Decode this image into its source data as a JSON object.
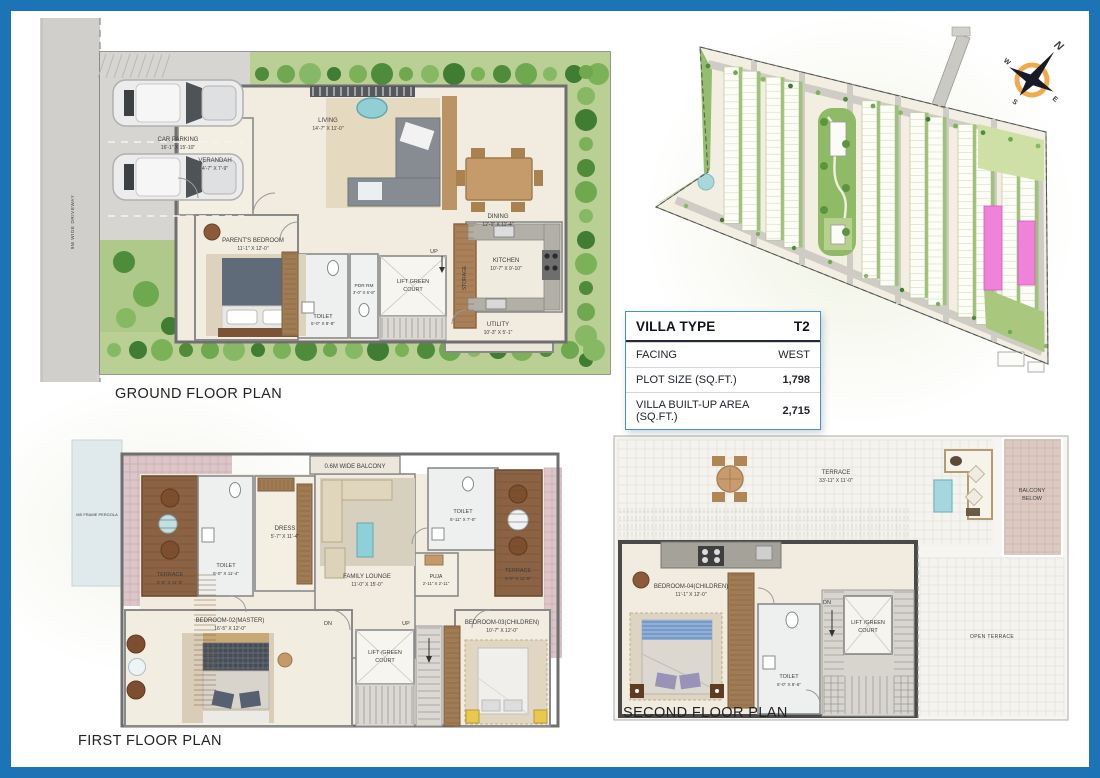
{
  "page": {
    "border_color": "#1c73b6",
    "background": "#ffffff"
  },
  "titles": {
    "ground": "GROUND FLOOR PLAN",
    "first": "FIRST FLOOR PLAN",
    "second": "SECOND FLOOR PLAN"
  },
  "villa_table": {
    "header_label": "VILLA TYPE",
    "header_value": "T2",
    "rows": [
      {
        "label": "FACING",
        "value": "WEST"
      },
      {
        "label": "PLOT SIZE (SQ.FT.)",
        "value": "1,798"
      },
      {
        "label": "VILLA BUILT-UP AREA (SQ.FT.)",
        "value": "2,715"
      }
    ]
  },
  "site_plan": {
    "compass": {
      "north": "N",
      "east": "E",
      "south": "S",
      "west": "W"
    },
    "highlight_color": "#ef82d9"
  },
  "ground_floor": {
    "driveway": "9M WIDE DRIVEWAY",
    "up": "UP",
    "car_parking": {
      "name": "CAR PARKING",
      "dims": "16'-1\" X 15'-10\""
    },
    "verandah": {
      "name": "VERANDAH",
      "dims": "4'-7\" X 7'-9\""
    },
    "living": {
      "name": "LIVING",
      "dims": "14'-7\" X 11'-0\""
    },
    "dining": {
      "name": "DINING",
      "dims": "12'-9\" X 11'-4\""
    },
    "kitchen": {
      "name": "KITCHEN",
      "dims": "10'-7\" X 9'-10\""
    },
    "parents_bedroom": {
      "name": "PARENT'S BEDROOM",
      "dims": "11'-1\" X 12'-0\""
    },
    "toilet": {
      "name": "TOILET",
      "dims": "5'-0\" X 8'-8\""
    },
    "pdr": {
      "name": "PDR RM",
      "dims": "3'-0\" X 6'-8\""
    },
    "lift": {
      "line1": "LIFT GREEN",
      "line2": "COURT"
    },
    "storage": "STORAGE",
    "utility": {
      "name": "UTILITY",
      "dims": "10'-3\" X 5'-1\""
    }
  },
  "first_floor": {
    "pergola": "MS FRAME PERGOLA",
    "balcony": "0.6M WIDE BALCONY",
    "terrace_left": {
      "name": "TERRACE",
      "dims": "5'-6\" X 11'-8\""
    },
    "toilet_left": {
      "name": "TOILET",
      "dims": "5'-0\" X 11'-4\""
    },
    "dress": {
      "name": "DRESS",
      "dims": "5'-7\" X 11'-4\""
    },
    "family_lounge": {
      "name": "FAMILY LOUNGE",
      "dims": "11'-0\" X 15'-0\""
    },
    "toilet_right": {
      "name": "TOILET",
      "dims": "5'-11\" X 7'-5\""
    },
    "puja": {
      "name": "PUJA",
      "dims": "2'-11\" X 2'-11\""
    },
    "terrace_right": {
      "name": "TERRACE",
      "dims": "5'-0\" X 11'-8\""
    },
    "bedroom2": {
      "name": "BEDROOM-02(MASTER)",
      "dims": "16'-5\" X 12'-0\""
    },
    "bedroom3": {
      "name": "BEDROOM-03(CHILDREN)",
      "dims": "10'-7\" X 12'-0\""
    },
    "lift": {
      "line1": "LIFT /GREEN",
      "line2": "COURT"
    },
    "dn": "DN",
    "up": "UP"
  },
  "second_floor": {
    "terrace": {
      "name": "TERRACE",
      "dims": "33'-11\" X 11'-0\""
    },
    "balcony_below": {
      "line1": "BALCONY",
      "line2": "BELOW"
    },
    "bedroom4": {
      "name": "BEDROOM-04(CHILDREN)",
      "dims": "11'-1\" X 12'-0\""
    },
    "lift": {
      "line1": "LIFT /GREEN",
      "line2": "COURT"
    },
    "toilet": {
      "name": "TOILET",
      "dims": "5'-0\" X 8'-6\""
    },
    "dn": "DN",
    "open_terrace": "OPEN TERRACE"
  }
}
